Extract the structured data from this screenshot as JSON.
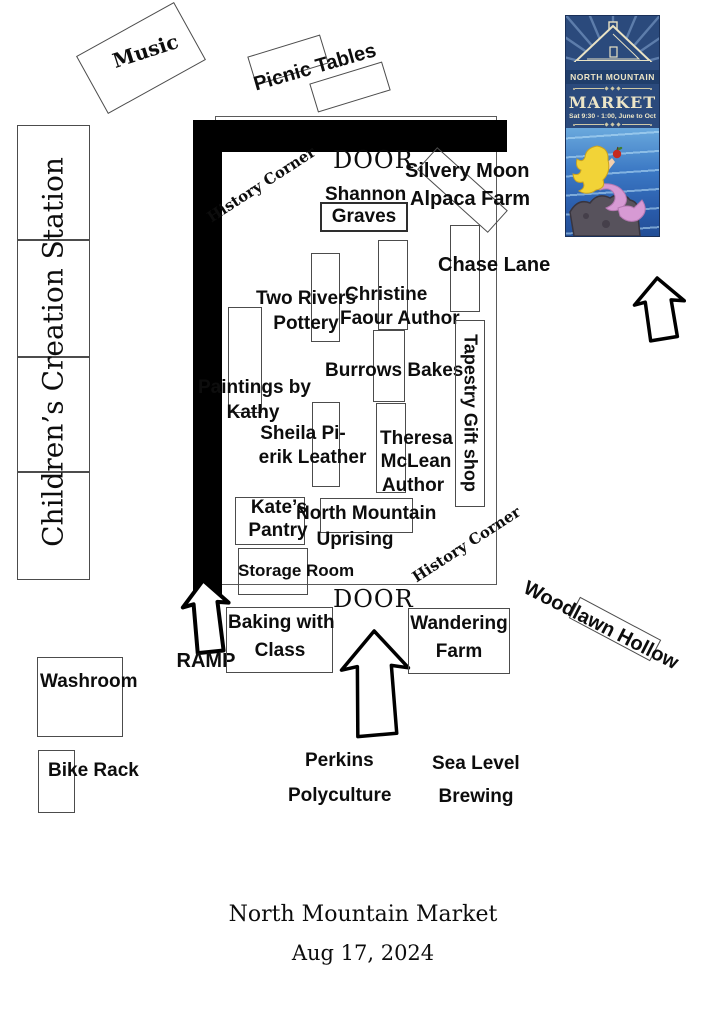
{
  "colors": {
    "wall_black": "#000000",
    "box_outline": "#4c4c4c",
    "poster_navy": "#2b4a7c",
    "poster_cream": "#ece5c7",
    "sea_blue": "#3b78c4",
    "hair_yellow": "#f2d337",
    "tail_pink": "#d79ad4",
    "apple_red": "#c52a20",
    "rock_gray": "#57525c"
  },
  "footer": {
    "title": "North Mountain Market",
    "date": "Aug 17, 2024"
  },
  "poster": {
    "org": "NORTH MOUNTAIN",
    "title": "MARKET",
    "schedule": "Sat 9:30 - 1:00, June to Oct"
  },
  "outside": {
    "music": "Music",
    "picnic_tables": "Picnic Tables",
    "children_station": "Children’s Creation Station",
    "ramp": "RAMP",
    "washroom": "Washroom",
    "bike_rack": "Bike Rack",
    "woodlawn_hollow": "Woodlawn Hollow",
    "baking": {
      "lines": [
        "Baking with",
        "Class"
      ]
    },
    "wandering": {
      "lines": [
        "Wandering",
        "Farm"
      ]
    },
    "perkins": {
      "lines": [
        "Perkins",
        "Polyculture"
      ]
    },
    "sea_level": {
      "lines": [
        "Sea Level",
        "Brewing"
      ]
    }
  },
  "market": {
    "door_top": "DOOR",
    "door_bottom": "DOOR",
    "history_corner_top": "History Corner",
    "history_corner_bottom": "History Corner",
    "vendors": {
      "shannon_graves": {
        "lines": [
          "Shannon",
          "Graves"
        ]
      },
      "silvery_moon": {
        "lines": [
          "Silvery Moon",
          "Alpaca Farm"
        ]
      },
      "chase_lane": {
        "lines": [
          "Chase Lane"
        ]
      },
      "two_rivers": {
        "lines": [
          "Two Rivers",
          "Pottery"
        ]
      },
      "christine_faour": {
        "lines": [
          "Christine",
          "Faour Author"
        ]
      },
      "burrows_bakes": {
        "lines": [
          "Burrows Bakes"
        ]
      },
      "tapestry": {
        "lines": [
          "Tapestry Gift shop"
        ]
      },
      "paintings_kathy": {
        "lines": [
          "Paintings by",
          "Kathy"
        ]
      },
      "sheila_pierik": {
        "lines": [
          "Sheila Pi-",
          "erik Leather"
        ]
      },
      "theresa_mclean": {
        "lines": [
          "Theresa",
          "McLean",
          "Author"
        ]
      },
      "kates_pantry": {
        "lines": [
          "Kate’s",
          "Pantry"
        ]
      },
      "nm_uprising": {
        "lines": [
          "North Mountain",
          "Uprising"
        ]
      },
      "storage_room": {
        "lines": [
          "Storage Room"
        ]
      }
    }
  }
}
